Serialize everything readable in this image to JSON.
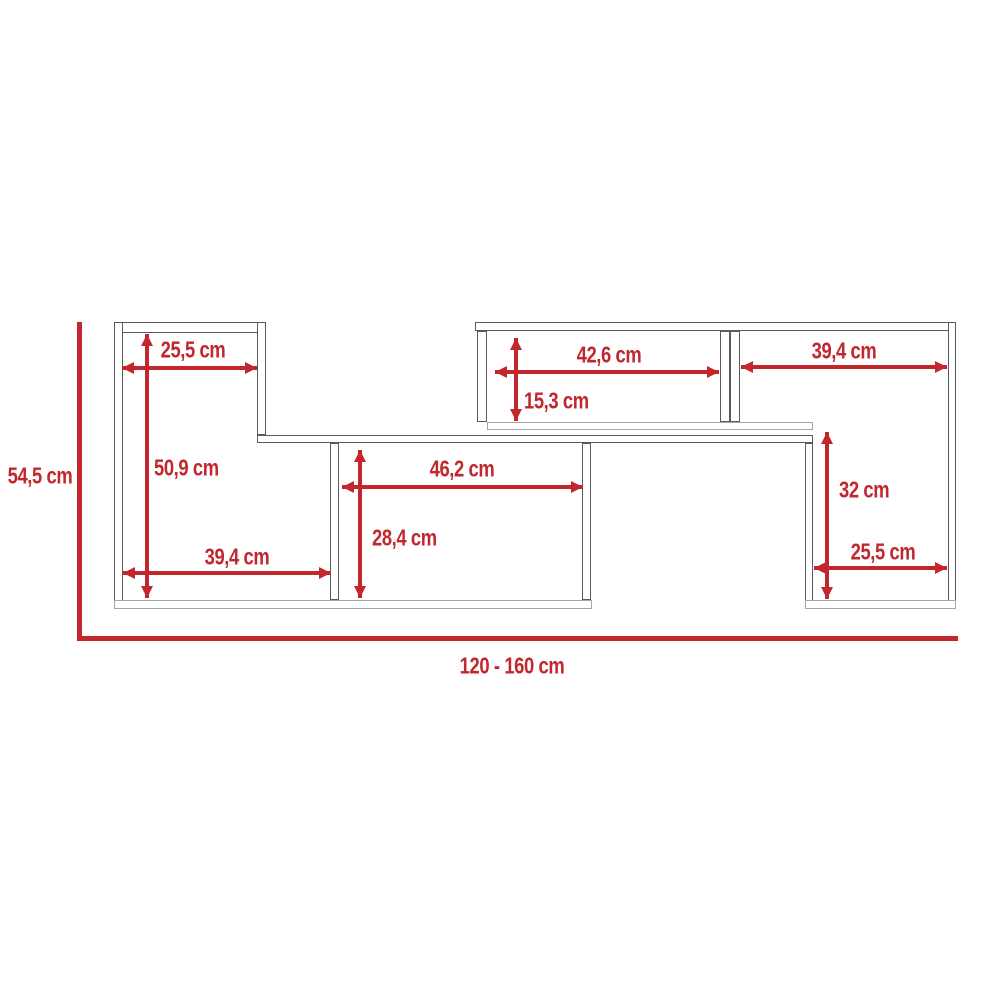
{
  "diagram": {
    "description": "Technical dimension drawing of a wall-mounted TV shelf unit with measurements in centimetres",
    "unit": "cm",
    "colors": {
      "accent": "#C1272D",
      "outline": "#5a5a5a",
      "outline_light": "#a6a6a6",
      "background": "#ffffff"
    },
    "overall_dimensions": {
      "height": {
        "label": "54,5 cm",
        "value_cm": 54.5,
        "line": {
          "x": 77,
          "y1": 322,
          "y2": 641,
          "thickness": 5
        },
        "label_pos": {
          "cx": 40,
          "cy": 476
        }
      },
      "width": {
        "label": "120 - 160 cm",
        "value_cm_min": 120,
        "value_cm_max": 160,
        "line": {
          "y": 636,
          "x1": 77,
          "x2": 958,
          "thickness": 5
        },
        "label_pos": {
          "cx": 512,
          "cy": 666
        }
      }
    },
    "panels": [
      {
        "name": "left-box-top-panel",
        "x": 114,
        "y": 322,
        "w": 152,
        "h": 11
      },
      {
        "name": "left-box-left-panel",
        "x": 114,
        "y": 322,
        "w": 9,
        "h": 286
      },
      {
        "name": "left-box-right-panel",
        "x": 257,
        "y": 322,
        "w": 9,
        "h": 113
      },
      {
        "name": "middle-shelf-panel",
        "x": 257,
        "y": 435,
        "w": 556,
        "h": 8
      },
      {
        "name": "middle-compartment-left-panel",
        "x": 330,
        "y": 443,
        "w": 9,
        "h": 157
      },
      {
        "name": "middle-compartment-right-panel",
        "x": 582,
        "y": 443,
        "w": 9,
        "h": 157
      },
      {
        "name": "bottom-left-panel",
        "x": 114,
        "y": 600,
        "w": 478,
        "h": 9,
        "shade": "light"
      },
      {
        "name": "upper-right-box-top-panel",
        "x": 475,
        "y": 322,
        "w": 481,
        "h": 9
      },
      {
        "name": "upper-right-box-left-panel",
        "x": 477,
        "y": 331,
        "w": 10,
        "h": 91
      },
      {
        "name": "upper-right-divider-panel-a",
        "x": 720,
        "y": 331,
        "w": 10,
        "h": 91
      },
      {
        "name": "upper-right-divider-panel-b",
        "x": 730,
        "y": 331,
        "w": 10,
        "h": 91
      },
      {
        "name": "upper-right-floor-panel",
        "x": 487,
        "y": 422,
        "w": 326,
        "h": 8,
        "shade": "light"
      },
      {
        "name": "right-box-left-panel",
        "x": 805,
        "y": 443,
        "w": 8,
        "h": 165
      },
      {
        "name": "right-box-right-panel",
        "x": 948,
        "y": 322,
        "w": 8,
        "h": 286
      },
      {
        "name": "right-box-bottom-panel",
        "x": 805,
        "y": 600,
        "w": 151,
        "h": 9,
        "shade": "light"
      }
    ],
    "dimensions_horizontal": [
      {
        "id": "left-shelf-width",
        "label": "25,5 cm",
        "value_cm": 25.5,
        "y": 368,
        "x1": 122,
        "x2": 257,
        "label_cx": 193,
        "label_cy": 350
      },
      {
        "id": "left-bottom-width",
        "label": "39,4 cm",
        "value_cm": 39.4,
        "y": 573,
        "x1": 123,
        "x2": 331,
        "label_cx": 237,
        "label_cy": 557
      },
      {
        "id": "middle-compartment-width",
        "label": "46,2 cm",
        "value_cm": 46.2,
        "y": 487,
        "x1": 342,
        "x2": 583,
        "label_cx": 462,
        "label_cy": 469
      },
      {
        "id": "upper-middle-compartment-width",
        "label": "42,6 cm",
        "value_cm": 42.6,
        "y": 372,
        "x1": 495,
        "x2": 719,
        "label_cx": 609,
        "label_cy": 355
      },
      {
        "id": "upper-right-compartment-width",
        "label": "39,4 cm",
        "value_cm": 39.4,
        "y": 367,
        "x1": 741,
        "x2": 947,
        "label_cx": 844,
        "label_cy": 351
      },
      {
        "id": "right-bottom-width",
        "label": "25,5 cm",
        "value_cm": 25.5,
        "y": 568,
        "x1": 814,
        "x2": 947,
        "label_cx": 883,
        "label_cy": 552
      }
    ],
    "dimensions_vertical": [
      {
        "id": "left-box-height",
        "label": "50,9 cm",
        "value_cm": 50.9,
        "x": 147,
        "y1": 334,
        "y2": 598,
        "label_x": 154,
        "label_cy": 468
      },
      {
        "id": "middle-compartment-height",
        "label": "28,4 cm",
        "value_cm": 28.4,
        "x": 360,
        "y1": 450,
        "y2": 598,
        "label_x": 372,
        "label_cy": 538
      },
      {
        "id": "upper-compartment-height",
        "label": "15,3 cm",
        "value_cm": 15.3,
        "x": 516,
        "y1": 338,
        "y2": 421,
        "label_x": 524,
        "label_cy": 401
      },
      {
        "id": "right-compartment-height",
        "label": "32 cm",
        "value_cm": 32,
        "x": 827,
        "y1": 432,
        "y2": 599,
        "label_x": 839,
        "label_cy": 490
      }
    ]
  }
}
